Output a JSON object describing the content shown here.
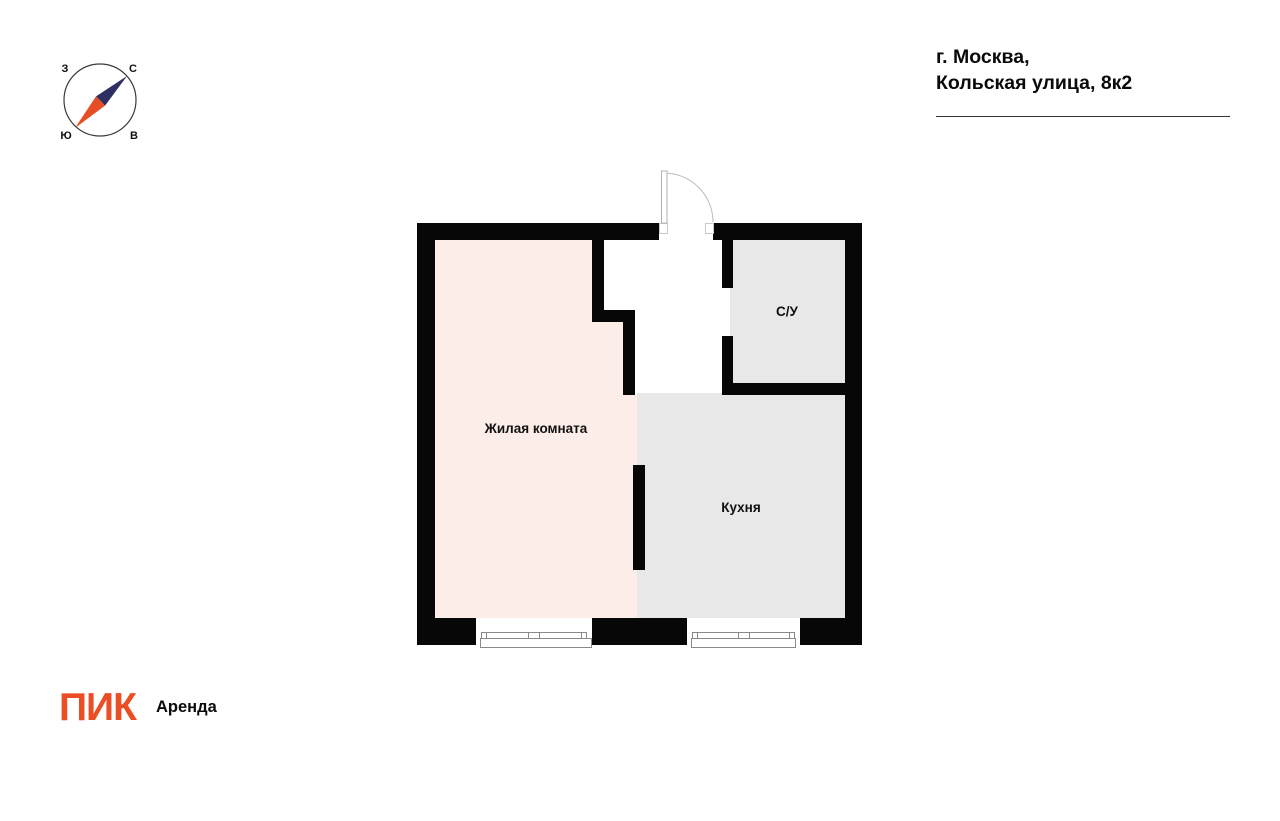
{
  "header": {
    "address_line1": "г. Москва,",
    "address_line2": "Кольская улица, 8к2"
  },
  "compass": {
    "west": "З",
    "north": "С",
    "south": "Ю",
    "east": "В",
    "needle": {
      "north_color": "#2F3061",
      "south_color": "#E84E24"
    }
  },
  "floor_plan": {
    "wall_color": "#070707",
    "rooms": [
      {
        "id": "living-room",
        "label": "Жилая комната",
        "fill": "#FCEDE9"
      },
      {
        "id": "kitchen",
        "label": "Кухня",
        "fill": "#E8E8E8"
      },
      {
        "id": "bathroom",
        "label": "С/У",
        "fill": "#E8E8E8"
      }
    ]
  },
  "footer": {
    "logo_primary": "ПИК",
    "logo_secondary": "Аренда",
    "logo_color": "#EB4D24"
  }
}
